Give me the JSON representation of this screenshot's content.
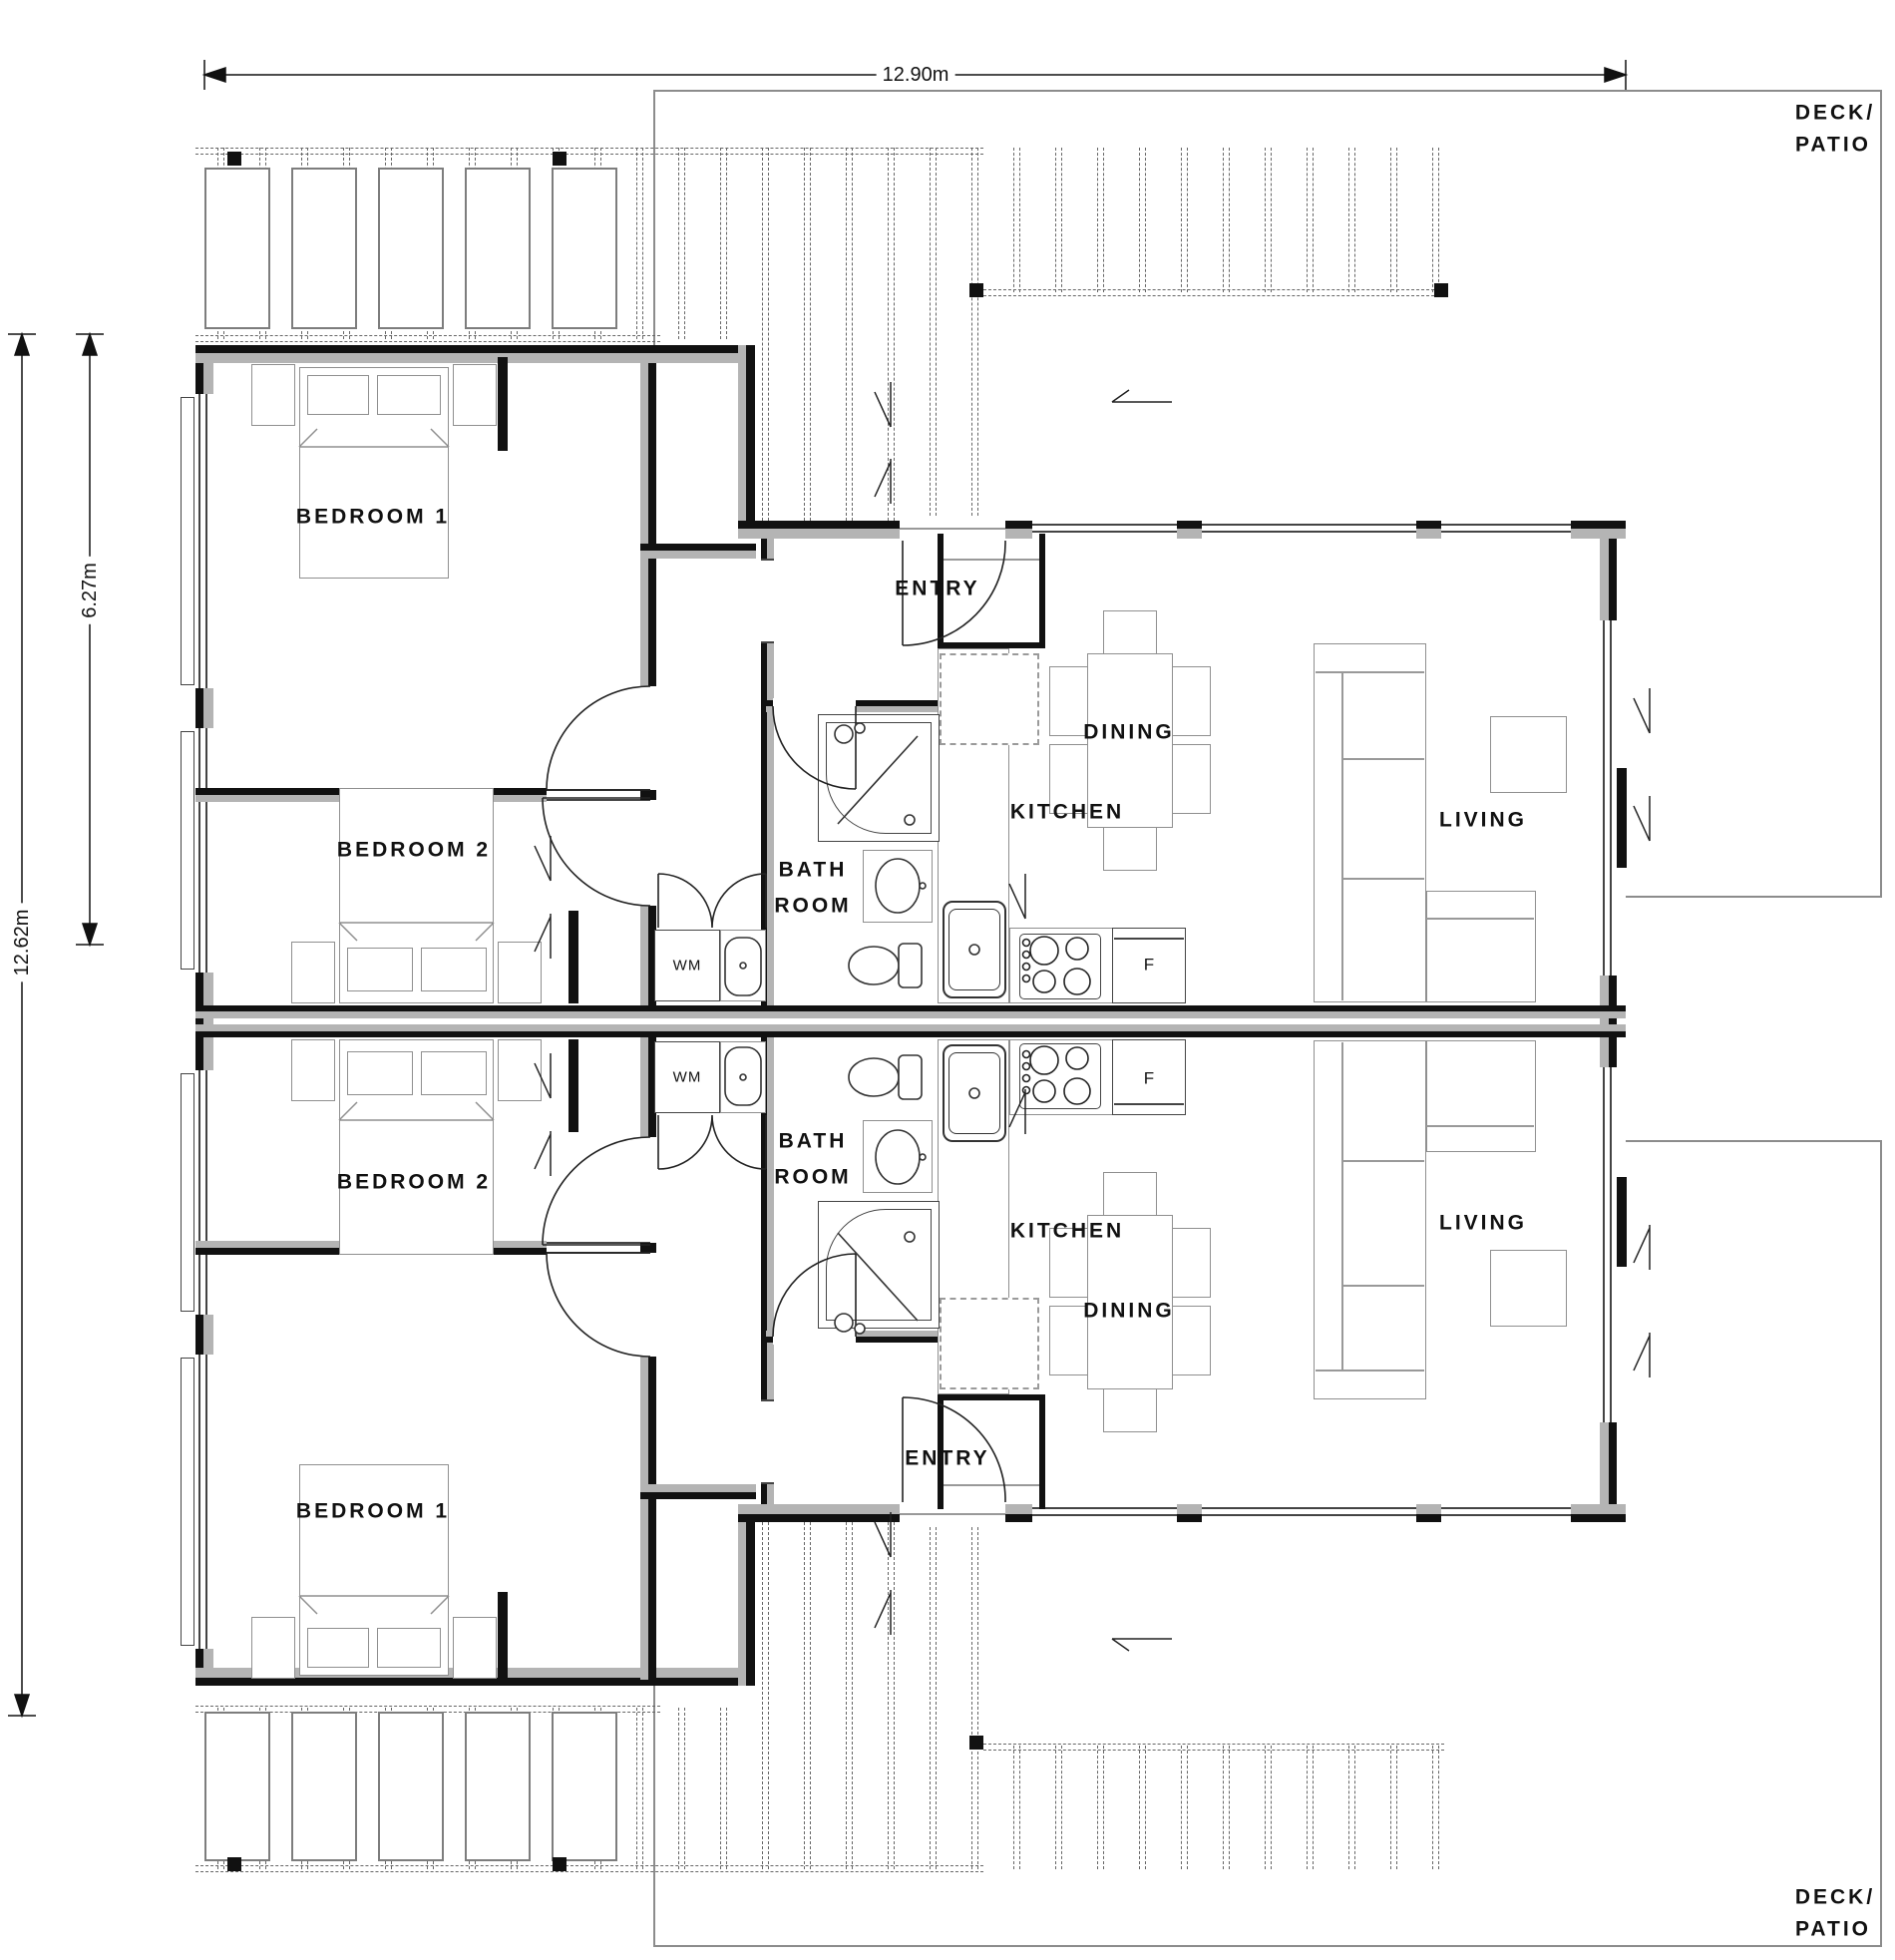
{
  "plan": {
    "dimensions": {
      "overall_width": "12.90m",
      "overall_depth": "12.62m",
      "unit_depth": "6.27m"
    },
    "outdoor": {
      "deck_label_line1": "DECK/",
      "deck_label_line2": "PATIO"
    },
    "units": [
      {
        "name": "upper-unit",
        "rooms": {
          "bedroom1": "BEDROOM 1",
          "bedroom2": "BEDROOM 2",
          "bathroom_line1": "BATH",
          "bathroom_line2": "ROOM",
          "kitchen": "KITCHEN",
          "dining": "DINING",
          "living": "LIVING",
          "entry": "ENTRY"
        },
        "appliances": {
          "washing_machine": "WM",
          "fridge": "F"
        }
      },
      {
        "name": "lower-unit",
        "rooms": {
          "bedroom1": "BEDROOM 1",
          "bedroom2": "BEDROOM 2",
          "bathroom_line1": "BATH",
          "bathroom_line2": "ROOM",
          "kitchen": "KITCHEN",
          "dining": "DINING",
          "living": "LIVING",
          "entry": "ENTRY"
        },
        "appliances": {
          "washing_machine": "WM",
          "fridge": "F"
        }
      }
    ],
    "colors": {
      "wall": "#111111",
      "wall_core": "#b4b4b4",
      "furniture_line": "#8f8f8f",
      "deck_line": "#8c8c8c"
    }
  }
}
